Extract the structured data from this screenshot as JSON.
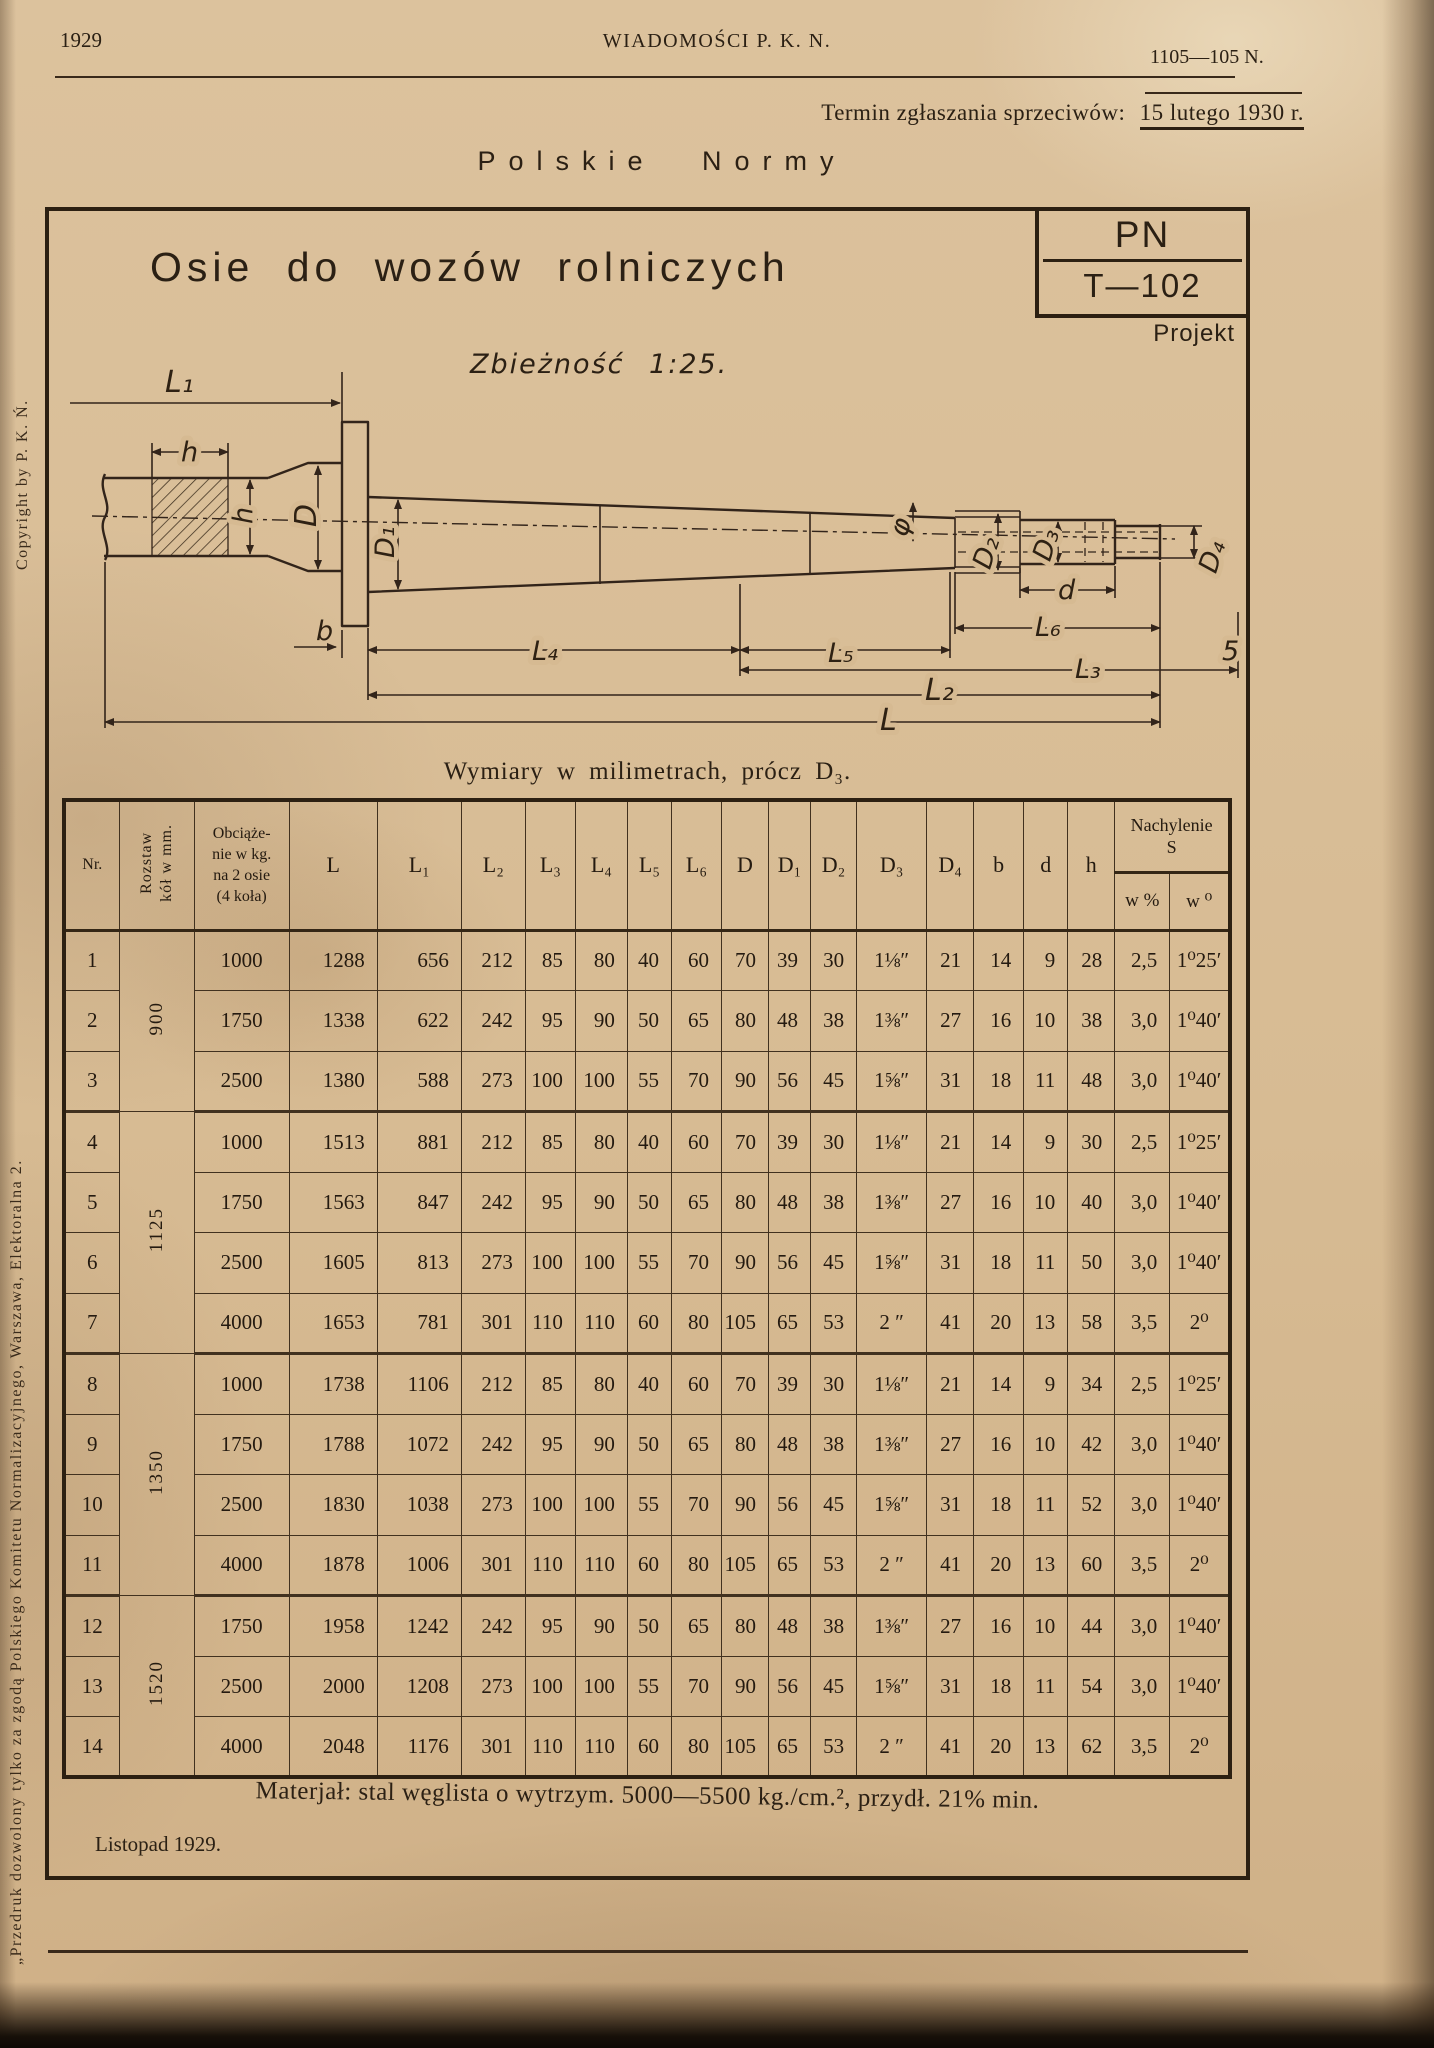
{
  "page_header": {
    "year": "1929",
    "journal_title": "WIADOMOŚCI P. K. N.",
    "issue_number": "1105—105 N.",
    "objection_deadline_label": "Termin zgłaszania sprzeciwów:",
    "objection_deadline_date": "15 lutego 1930 r.",
    "series_title": "Polskie Normy"
  },
  "left_margin": {
    "copyright_note": "Copyright by P. K. Ń.",
    "reprint_note": "„Przedruk dozwolony tylko za zgodą Polskiego Komitetu Normalizacyjnego, Warszawa, Elektoralna 2."
  },
  "norm_card": {
    "title": "Osie do wozów rolniczych",
    "norm_mark": "PN",
    "norm_number": "T—102",
    "status": "Projekt"
  },
  "drawing": {
    "taper_note": "Zbieżność 1:25.",
    "labels": {
      "L1": "L₁",
      "h": "h",
      "D": "D",
      "D1": "D₁",
      "b": "b",
      "L4": "L₄",
      "L5": "L₅",
      "L6": "L₆",
      "L3": "L₃",
      "L2": "L₂",
      "L": "L",
      "phi": "φ",
      "d": "d",
      "D2": "D₂",
      "D3": "D₃",
      "D4": "D₄",
      "chamfer": "5"
    }
  },
  "dimensions_table": {
    "caption": "Wymiary w milimetrach, prócz D₃.",
    "headers": {
      "nr": "Nr.",
      "rozstaw": [
        "Rozstaw",
        "kół w mm."
      ],
      "obciazenie": [
        "Obciąże-",
        "nie w kg.",
        "na 2 osie",
        "(4 koła)"
      ],
      "cols": [
        "L",
        "L₁",
        "L₂",
        "L₃",
        "L₄",
        "L₅",
        "L₆",
        "D",
        "D₁",
        "D₂",
        "D₃",
        "D₄",
        "b",
        "d",
        "h"
      ],
      "nachylenie_title": "Nachylenie",
      "nachylenie_sub": "S",
      "w_percent": "w %",
      "w_degree": "w ⁰"
    },
    "groups": [
      {
        "rozstaw": "900",
        "rows": [
          {
            "nr": "1",
            "cells": [
              "1000",
              "1288",
              "656",
              "212",
              "85",
              "80",
              "40",
              "60",
              "70",
              "39",
              "30",
              "1⅛″",
              "21",
              "14",
              "9",
              "28",
              "2,5",
              "1⁰25′"
            ]
          },
          {
            "nr": "2",
            "cells": [
              "1750",
              "1338",
              "622",
              "242",
              "95",
              "90",
              "50",
              "65",
              "80",
              "48",
              "38",
              "1⅜″",
              "27",
              "16",
              "10",
              "38",
              "3,0",
              "1⁰40′"
            ]
          },
          {
            "nr": "3",
            "cells": [
              "2500",
              "1380",
              "588",
              "273",
              "100",
              "100",
              "55",
              "70",
              "90",
              "56",
              "45",
              "1⅝″",
              "31",
              "18",
              "11",
              "48",
              "3,0",
              "1⁰40′"
            ]
          }
        ]
      },
      {
        "rozstaw": "1125",
        "rows": [
          {
            "nr": "4",
            "cells": [
              "1000",
              "1513",
              "881",
              "212",
              "85",
              "80",
              "40",
              "60",
              "70",
              "39",
              "30",
              "1⅛″",
              "21",
              "14",
              "9",
              "30",
              "2,5",
              "1⁰25′"
            ]
          },
          {
            "nr": "5",
            "cells": [
              "1750",
              "1563",
              "847",
              "242",
              "95",
              "90",
              "50",
              "65",
              "80",
              "48",
              "38",
              "1⅜″",
              "27",
              "16",
              "10",
              "40",
              "3,0",
              "1⁰40′"
            ]
          },
          {
            "nr": "6",
            "cells": [
              "2500",
              "1605",
              "813",
              "273",
              "100",
              "100",
              "55",
              "70",
              "90",
              "56",
              "45",
              "1⅝″",
              "31",
              "18",
              "11",
              "50",
              "3,0",
              "1⁰40′"
            ]
          },
          {
            "nr": "7",
            "cells": [
              "4000",
              "1653",
              "781",
              "301",
              "110",
              "110",
              "60",
              "80",
              "105",
              "65",
              "53",
              "2 ″",
              "41",
              "20",
              "13",
              "58",
              "3,5",
              "2⁰"
            ]
          }
        ]
      },
      {
        "rozstaw": "1350",
        "rows": [
          {
            "nr": "8",
            "cells": [
              "1000",
              "1738",
              "1106",
              "212",
              "85",
              "80",
              "40",
              "60",
              "70",
              "39",
              "30",
              "1⅛″",
              "21",
              "14",
              "9",
              "34",
              "2,5",
              "1⁰25′"
            ]
          },
          {
            "nr": "9",
            "cells": [
              "1750",
              "1788",
              "1072",
              "242",
              "95",
              "90",
              "50",
              "65",
              "80",
              "48",
              "38",
              "1⅜″",
              "27",
              "16",
              "10",
              "42",
              "3,0",
              "1⁰40′"
            ]
          },
          {
            "nr": "10",
            "cells": [
              "2500",
              "1830",
              "1038",
              "273",
              "100",
              "100",
              "55",
              "70",
              "90",
              "56",
              "45",
              "1⅝″",
              "31",
              "18",
              "11",
              "52",
              "3,0",
              "1⁰40′"
            ]
          },
          {
            "nr": "11",
            "cells": [
              "4000",
              "1878",
              "1006",
              "301",
              "110",
              "110",
              "60",
              "80",
              "105",
              "65",
              "53",
              "2 ″",
              "41",
              "20",
              "13",
              "60",
              "3,5",
              "2⁰"
            ]
          }
        ]
      },
      {
        "rozstaw": "1520",
        "rows": [
          {
            "nr": "12",
            "cells": [
              "1750",
              "1958",
              "1242",
              "242",
              "95",
              "90",
              "50",
              "65",
              "80",
              "48",
              "38",
              "1⅜″",
              "27",
              "16",
              "10",
              "44",
              "3,0",
              "1⁰40′"
            ]
          },
          {
            "nr": "13",
            "cells": [
              "2500",
              "2000",
              "1208",
              "273",
              "100",
              "100",
              "55",
              "70",
              "90",
              "56",
              "45",
              "1⅝″",
              "31",
              "18",
              "11",
              "54",
              "3,0",
              "1⁰40′"
            ]
          },
          {
            "nr": "14",
            "cells": [
              "4000",
              "2048",
              "1176",
              "301",
              "110",
              "110",
              "60",
              "80",
              "105",
              "65",
              "53",
              "2 ″",
              "41",
              "20",
              "13",
              "62",
              "3,5",
              "2⁰"
            ]
          }
        ]
      }
    ]
  },
  "footer": {
    "material_note": "Materjał: stal węglista o wytrzym. 5000—5500 kg./cm.², przydł. 21% min.",
    "issue_date": "Listopad 1929."
  }
}
